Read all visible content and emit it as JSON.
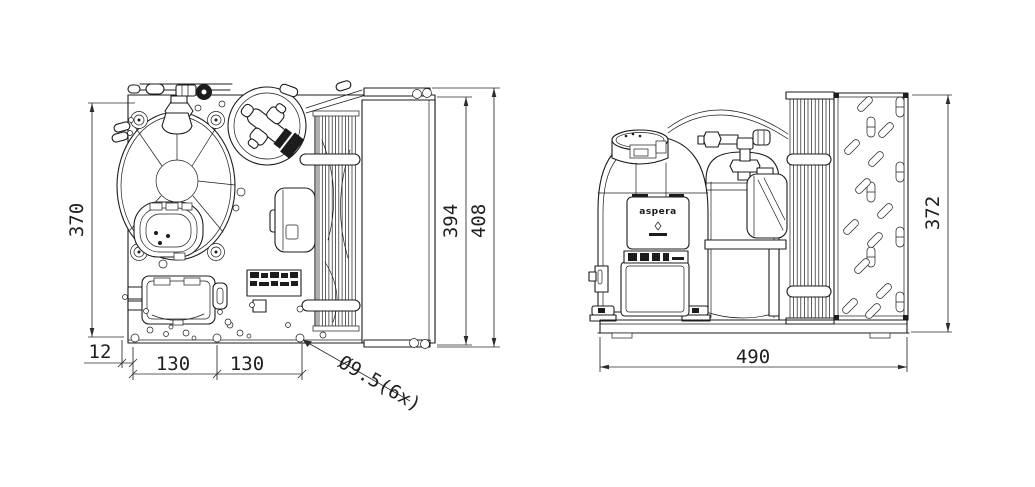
{
  "drawing": {
    "background": "#ffffff",
    "line_color": "#1c1c1c",
    "brand_label": "aspera",
    "dims": {
      "plate_height": "370",
      "coil_height": "394",
      "overall_depth": "408",
      "edge_offset": "12",
      "hole_pitch_a": "130",
      "hole_pitch_b": "130",
      "hole_callout": "Ø9.5(6x)",
      "base_width": "490",
      "unit_height": "372"
    }
  }
}
